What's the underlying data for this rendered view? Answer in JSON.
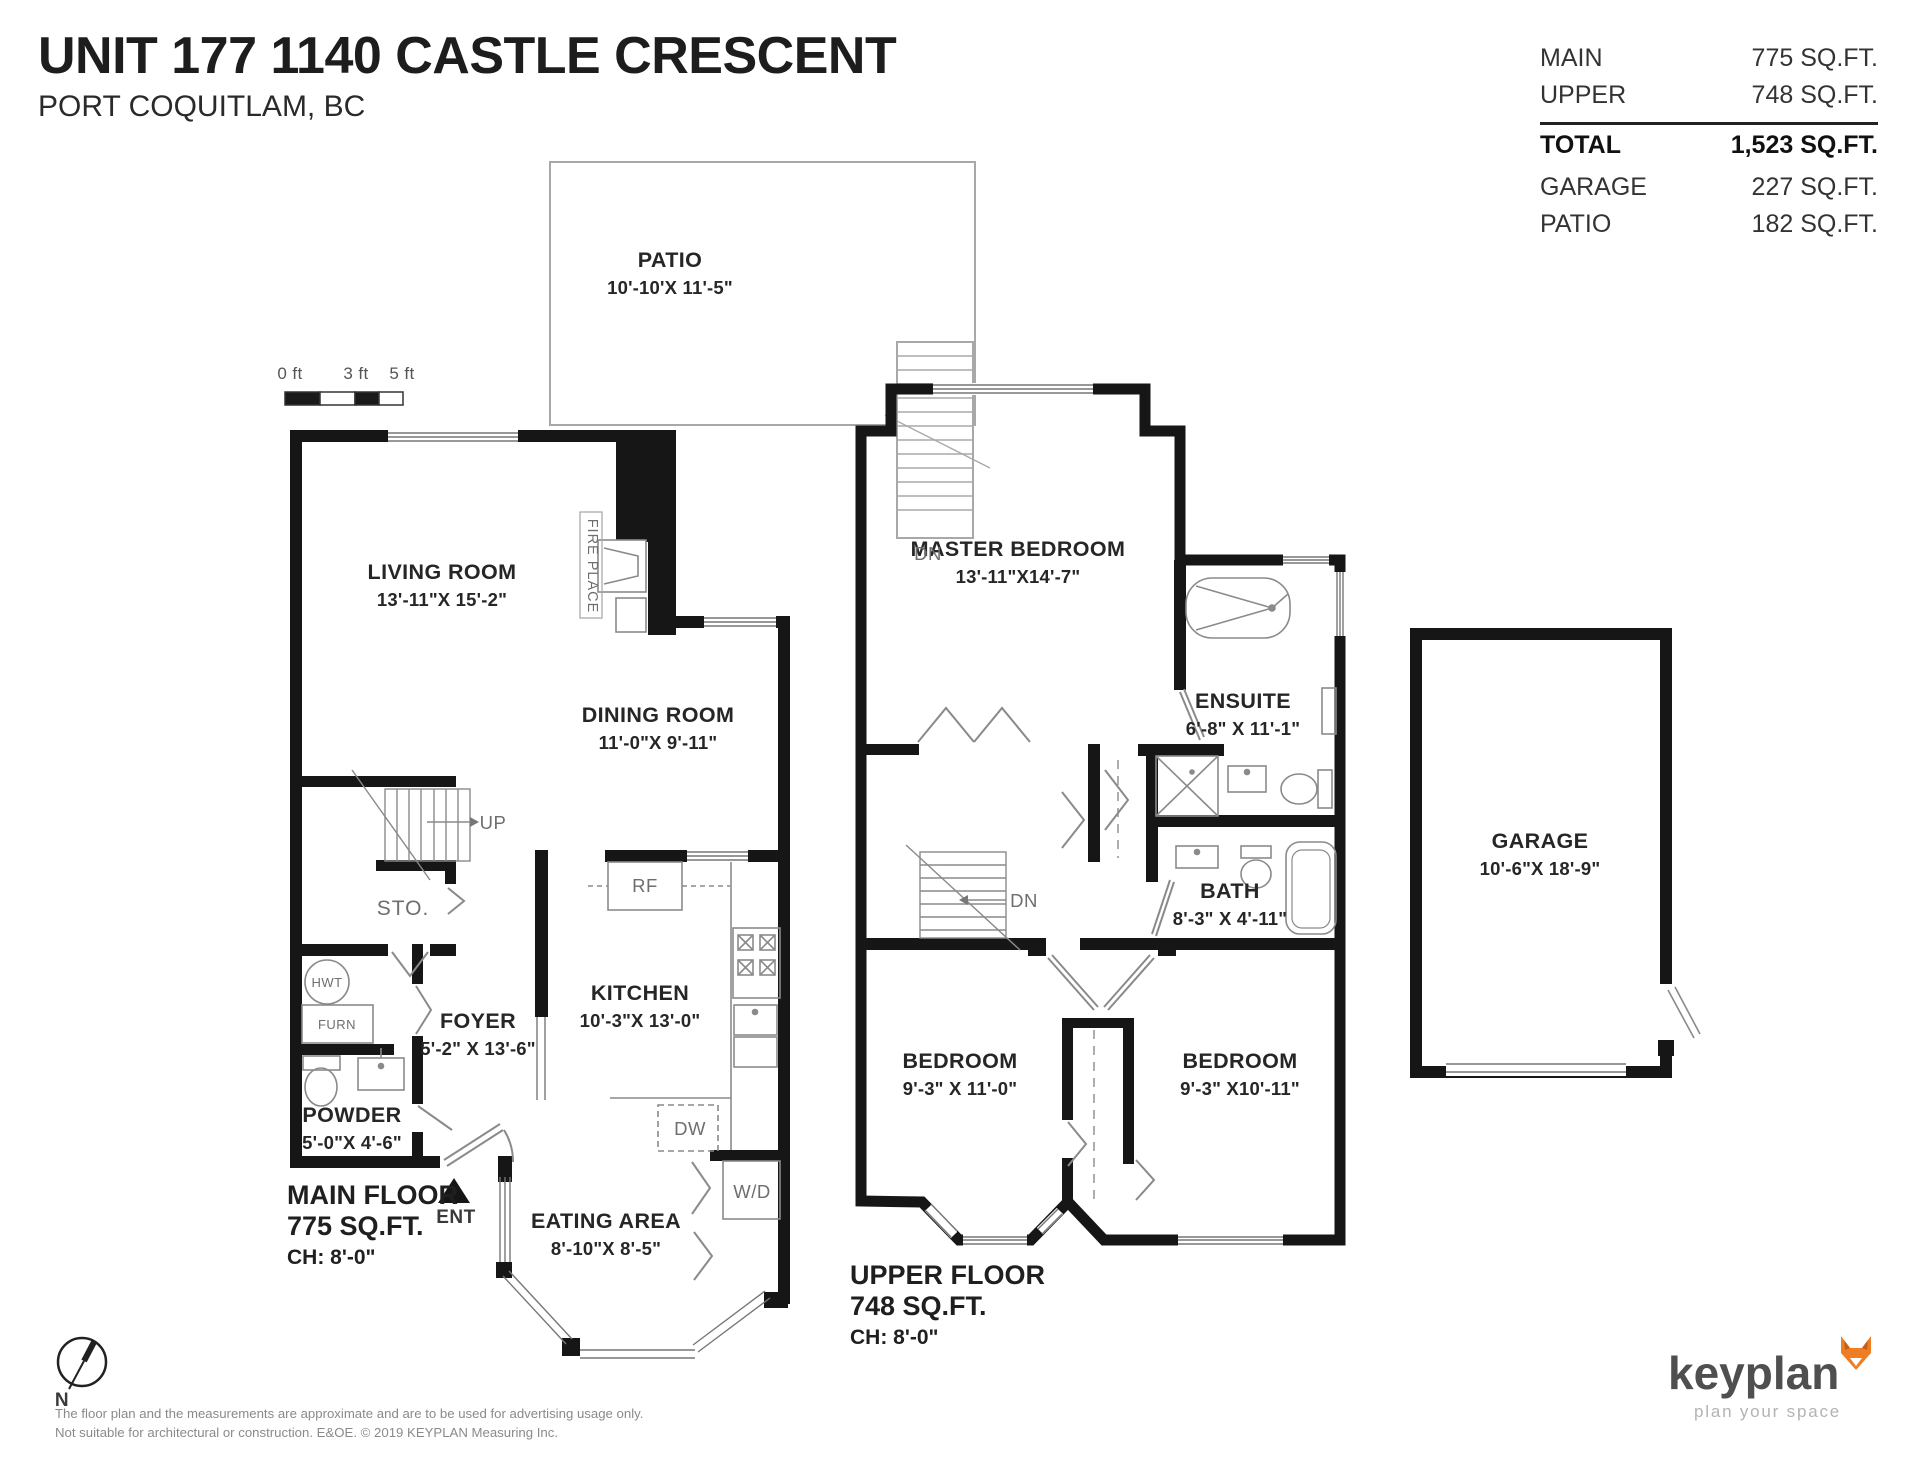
{
  "header": {
    "title": "UNIT 177 1140 CASTLE CRESCENT",
    "subtitle": "PORT COQUITLAM, BC"
  },
  "area_table": {
    "rows": [
      {
        "label": "MAIN",
        "value": "775 SQ.FT.",
        "bold": false,
        "rule_above": false
      },
      {
        "label": "UPPER",
        "value": "748 SQ.FT.",
        "bold": false,
        "rule_above": false
      },
      {
        "label": "TOTAL",
        "value": "1,523 SQ.FT.",
        "bold": true,
        "rule_above": true
      },
      {
        "label": "GARAGE",
        "value": "227 SQ.FT.",
        "bold": false,
        "rule_above": false
      },
      {
        "label": "PATIO",
        "value": "182 SQ.FT.",
        "bold": false,
        "rule_above": false
      }
    ]
  },
  "colors": {
    "wall": "#161616",
    "fixture_line": "#8a8a8a",
    "brand_orange": "#ef7d23"
  },
  "labels": [
    {
      "n": "patio-label",
      "t": "PATIO",
      "s": "10'-10'X 11'-5\"",
      "x": 670,
      "y": 248,
      "cls": "room"
    },
    {
      "n": "living-room-label",
      "t": "LIVING ROOM",
      "s": "13'-11\"X 15'-2\"",
      "x": 442,
      "y": 560,
      "cls": "room"
    },
    {
      "n": "dining-room-label",
      "t": "DINING ROOM",
      "s": "11'-0\"X 9'-11\"",
      "x": 658,
      "y": 703,
      "cls": "room"
    },
    {
      "n": "kitchen-label",
      "t": "KITCHEN",
      "s": "10'-3\"X 13'-0\"",
      "x": 640,
      "y": 981,
      "cls": "room"
    },
    {
      "n": "foyer-label",
      "t": "FOYER",
      "s": "5'-2\" X 13'-6\"",
      "x": 478,
      "y": 1009,
      "cls": "room"
    },
    {
      "n": "powder-label",
      "t": "POWDER",
      "s": "5'-0\"X 4'-6\"",
      "x": 352,
      "y": 1103,
      "cls": "room"
    },
    {
      "n": "eating-area-label",
      "t": "EATING AREA",
      "s": "8'-10\"X 8'-5\"",
      "x": 606,
      "y": 1209,
      "cls": "room"
    },
    {
      "n": "master-bedroom-label",
      "t": "MASTER BEDROOM",
      "s": "13'-11\"X14'-7\"",
      "x": 1018,
      "y": 537,
      "cls": "room"
    },
    {
      "n": "ensuite-label",
      "t": "ENSUITE",
      "s": "6'-8\" X 11'-1\"",
      "x": 1243,
      "y": 689,
      "cls": "room"
    },
    {
      "n": "bath-label",
      "t": "BATH",
      "s": "8'-3\" X 4'-11\"",
      "x": 1230,
      "y": 879,
      "cls": "room"
    },
    {
      "n": "bedroom-left-label",
      "t": "BEDROOM",
      "s": "9'-3\" X 11'-0\"",
      "x": 960,
      "y": 1049,
      "cls": "room"
    },
    {
      "n": "bedroom-right-label",
      "t": "BEDROOM",
      "s": "9'-3\" X10'-11\"",
      "x": 1240,
      "y": 1049,
      "cls": "room"
    },
    {
      "n": "garage-label",
      "t": "GARAGE",
      "s": "10'-6\"X 18'-9\"",
      "x": 1540,
      "y": 829,
      "cls": "room"
    },
    {
      "n": "main-floor-label",
      "lines": [
        "MAIN FLOOR",
        "775 SQ.FT."
      ],
      "ch": "CH: 8'-0\"",
      "x": 287,
      "y": 1180,
      "cls": "floor"
    },
    {
      "n": "upper-floor-label",
      "lines": [
        "UPPER FLOOR",
        "748 SQ.FT."
      ],
      "ch": "CH: 8'-0\"",
      "x": 850,
      "y": 1260,
      "cls": "floor"
    },
    {
      "n": "dn-patio-label",
      "t": "DN",
      "x": 928,
      "y": 543,
      "cls": "sm"
    },
    {
      "n": "up-label",
      "t": "UP",
      "x": 493,
      "y": 812,
      "cls": "sm"
    },
    {
      "n": "storage-label",
      "t": "STO.",
      "x": 403,
      "y": 897,
      "cls": "sm2"
    },
    {
      "n": "fridge-label",
      "t": "RF",
      "x": 645,
      "y": 875,
      "cls": "sm"
    },
    {
      "n": "dishwasher-label",
      "t": "DW",
      "x": 690,
      "y": 1118,
      "cls": "sm"
    },
    {
      "n": "washer-dryer-label",
      "t": "W/D",
      "x": 752,
      "y": 1181,
      "cls": "sm"
    },
    {
      "n": "hot-water-tank-label",
      "t": "HWT",
      "x": 327,
      "y": 975,
      "cls": "xs"
    },
    {
      "n": "furnace-label",
      "t": "FURN",
      "x": 337,
      "y": 1017,
      "cls": "xs"
    },
    {
      "n": "entry-label",
      "t": "ENT",
      "x": 456,
      "y": 1207,
      "cls": "sm3"
    },
    {
      "n": "fireplace-label",
      "t": "FIRE PLACE",
      "x": 592,
      "y": 566,
      "cls": "vert"
    },
    {
      "n": "dn-upper-label",
      "t": "DN",
      "x": 1024,
      "y": 890,
      "cls": "sm"
    },
    {
      "n": "north-label",
      "t": "N",
      "x": 62,
      "y": 1390,
      "cls": "sm3"
    },
    {
      "n": "scale-0ft",
      "t": "0 ft",
      "x": 290,
      "y": 364,
      "cls": "tick"
    },
    {
      "n": "scale-3ft",
      "t": "3 ft",
      "x": 356,
      "y": 364,
      "cls": "tick"
    },
    {
      "n": "scale-5ft",
      "t": "5 ft",
      "x": 402,
      "y": 364,
      "cls": "tick"
    }
  ],
  "footer": {
    "disclaimer1": "The floor plan and the measurements are approximate and are to be used for advertising usage only.",
    "disclaimer2": "Not suitable for architectural or construction. E&OE. © 2019 KEYPLAN Measuring Inc.",
    "logo_name": "keyplan",
    "logo_tagline": "plan your space"
  }
}
